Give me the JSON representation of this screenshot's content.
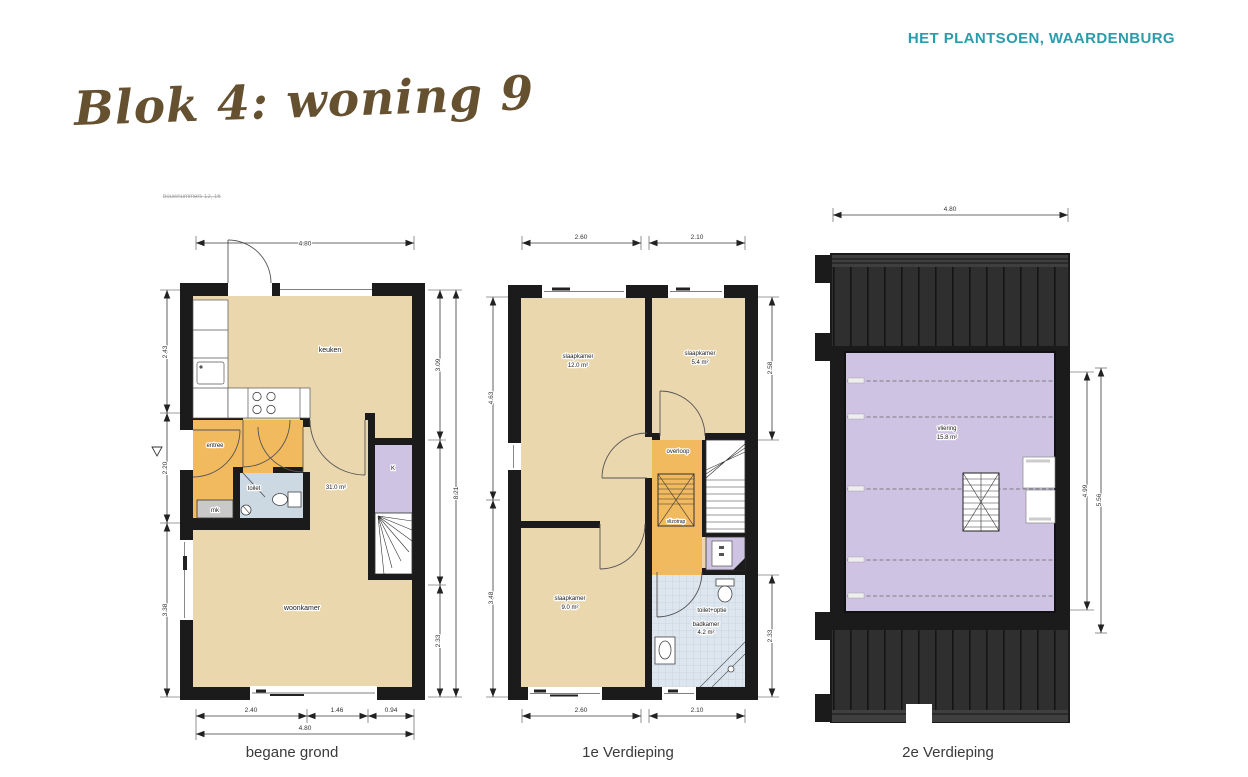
{
  "header": {
    "project": "HET PLANTSOEN, WAARDENBURG",
    "accent_color": "#2a9cab"
  },
  "title": {
    "text": "Blok 4: woning 9",
    "color": "#65502f"
  },
  "note": {
    "text": "bouwnummers 12, 16"
  },
  "colors": {
    "room_beige": "#ebd7ae",
    "room_orange": "#f2ba5f",
    "room_blue": "#ccd9e3",
    "room_tile": "#dde6ef",
    "room_purple": "#cfc3e3",
    "wall": "#1b1b1b",
    "roof": "#2f2f2f"
  },
  "plans": {
    "ground": {
      "caption": "begane grond",
      "labels": {
        "keuken": "keuken",
        "entree": "entree",
        "toilet": "toilet",
        "mk": "mk",
        "kast": "K",
        "area": "31.0 m²",
        "woonkamer": "woonkamer"
      },
      "dims": {
        "top": "4.80",
        "left": [
          "2.43",
          "2.20",
          "3.38"
        ],
        "right": [
          "3.09",
          "2.33",
          "8.21"
        ],
        "bottom": [
          "2.40",
          "1.46",
          "0.94",
          "4.80"
        ]
      }
    },
    "first": {
      "caption": "1e Verdieping",
      "labels": {
        "slaapkamer1": "slaapkamer",
        "slaapkamer1_area": "12.0 m²",
        "slaapkamer2": "slaapkamer",
        "slaapkamer2_area": "5.4 m²",
        "overloop": "overloop",
        "vlizotrap": "vlizotrap",
        "slaapkamer3": "slaapkamer",
        "slaapkamer3_area": "9.0 m²",
        "badkamer": "badkamer",
        "badkamer_area": "4.2 m²",
        "toilet_optie": "toilet+optie"
      },
      "dims": {
        "top": [
          "2.60",
          "2.10"
        ],
        "left": [
          "4.63",
          "3.48"
        ],
        "right": [
          "2.58",
          "2.33"
        ],
        "bottom": [
          "2.60",
          "2.10"
        ]
      }
    },
    "second": {
      "caption": "2e Verdieping",
      "labels": {
        "vliering": "vliering",
        "vliering_area": "15.8 m²"
      },
      "dims": {
        "top": "4.80",
        "right": [
          "4.99",
          "5.56"
        ]
      }
    }
  }
}
